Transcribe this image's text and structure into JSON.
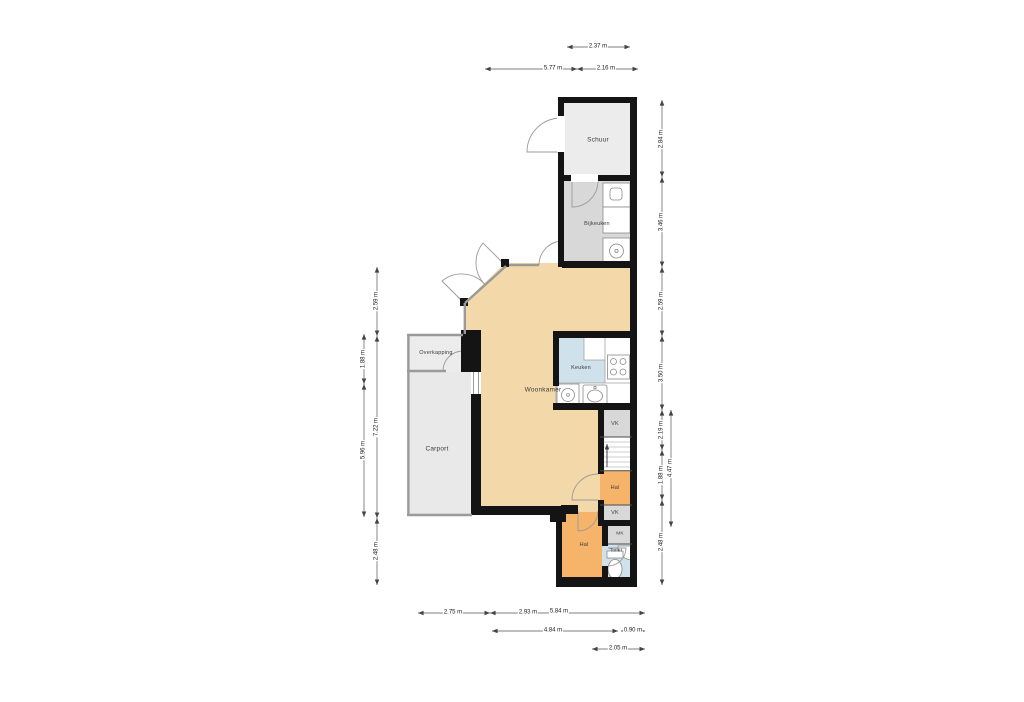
{
  "rooms": {
    "schuur": "Schuur",
    "bijkeuken": "Bijkeuken",
    "woonkamer": "Woonkamer",
    "keuken": "Keuken",
    "overkapping": "Overkapping",
    "carport": "Carport",
    "hal_mid": "Hal",
    "hal_entry": "Hal",
    "vk_upper": "VK",
    "vk_lower": "VK",
    "mk": "MK",
    "toilet": "Toilet"
  },
  "dims": {
    "top": [
      "2.37 m",
      "5.77 m",
      "2.16 m"
    ],
    "bottom": [
      "2.75 m",
      "2.93 m",
      "5.84 m",
      "4.84 m",
      "0.90 m",
      "2.05 m"
    ],
    "right": [
      "2.84 m",
      "3.46 m",
      "2.59 m",
      "3.50 m",
      "2.19 m",
      "1.88 m",
      "2.48 m",
      "4.47 m"
    ],
    "left": [
      "2.59 m",
      "7.22 m",
      "2.48 m",
      "1.88 m",
      "5.96 m"
    ]
  },
  "colors": {
    "floor_living": "#f3d9a9",
    "floor_hall": "#f6b46a",
    "floor_wet": "#cfe1eb",
    "floor_utility": "#d8d8d8",
    "floor_outdoor": "#ececec",
    "wall": "#141414",
    "thinwall": "#9a9a9a",
    "fixture": "#8a8a8a",
    "dimline": "#555555"
  }
}
